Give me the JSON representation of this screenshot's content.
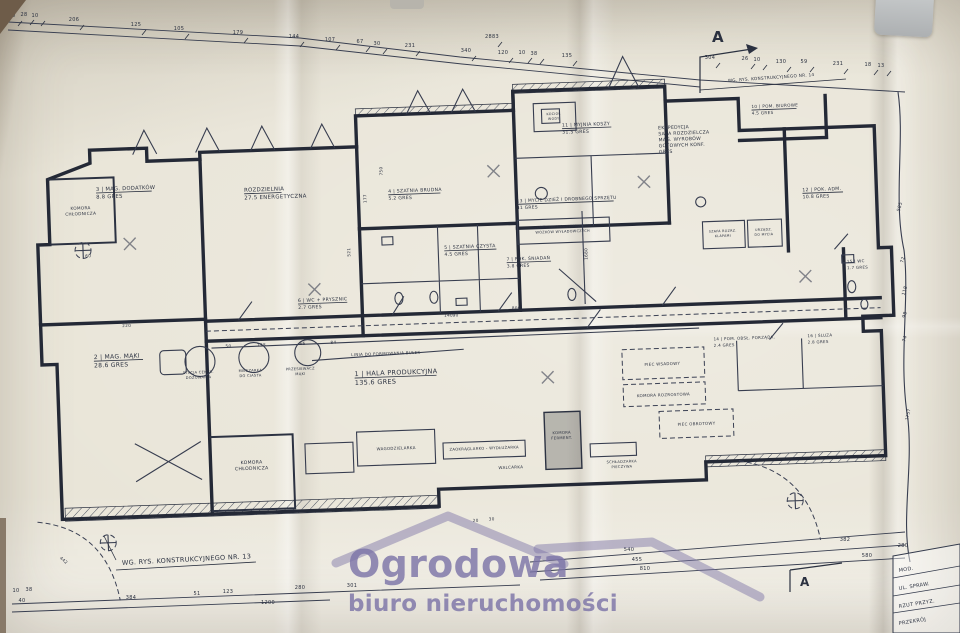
{
  "watermark": {
    "line1": "Ogrodowa",
    "line2": "biuro nieruchomości"
  },
  "annotations": {
    "note_bottom": "WG. RYS. KONSTRUKCYJNEGO NR. 13",
    "note_top": "WG. RYS. KONSTRUKCYJNEGO NR. 14",
    "section_top": "A",
    "section_bottom": "A",
    "ekspedycja": [
      "EKSPEDYCJA",
      "SALA ROZDZIELCZA",
      "MAG. WYROBÓW",
      "GOTOWYCH KONF.",
      "GRES"
    ]
  },
  "rooms": [
    {
      "id": "1",
      "name": "HALA PRODUKCYJNA",
      "area": "135.6",
      "finish": "GRES",
      "lines": [
        "1 | HALA PRODUKCYJNA",
        "135.6  GRES"
      ]
    },
    {
      "id": "2",
      "name": "MAG. MĄKI",
      "area": "28.6",
      "finish": "GRES",
      "lines": [
        "2 | MAG. MĄKI",
        "28.6  GRES"
      ]
    },
    {
      "id": "3",
      "name": "MAG. DODATKÓW",
      "area": "8.8",
      "finish": "GRES",
      "lines": [
        "3 | MAG. DODATKÓW",
        "8.8  GRES"
      ]
    },
    {
      "id": "4",
      "name": "SZATNIA BRUDNA",
      "area": "5.2",
      "finish": "GRES",
      "lines": [
        "4 | SZATNIA BRUDNA",
        "5.2  GRES"
      ]
    },
    {
      "id": "5",
      "name": "SZATNIA CZYSTA",
      "area": "4.5",
      "finish": "GRES",
      "lines": [
        "5 | SZATNIA CZYSTA",
        "4.5  GRES"
      ]
    },
    {
      "id": "6",
      "name": "WC + PRYSZNIC",
      "area": "2.7",
      "finish": "GRES",
      "lines": [
        "6 | WC + PRYSZNIC",
        "2.7  GRES"
      ]
    },
    {
      "id": "7",
      "name": "POK. ŚNIADAŃ",
      "area": "3.8",
      "finish": "GRES",
      "lines": [
        "7 | POK. ŚNIADAŃ",
        "3.8  GRES"
      ]
    },
    {
      "id": "9",
      "name": "ROZDZIELNIA ENERGETYCZNA",
      "area": "27.5",
      "finish": "",
      "lines": [
        "ROZDZIELNIA",
        "27.5  ENERGETYCZNA"
      ]
    },
    {
      "id": "11",
      "name": "MYJNIA KOSZY",
      "area": "31.5",
      "finish": "GRES",
      "lines": [
        "11 | MYJNIA KOSZY",
        "31.5  GRES"
      ]
    },
    {
      "id": "10",
      "name": "POM. BIUROWE",
      "area": "4.5",
      "finish": "GRES",
      "lines": [
        "10 | POM. BIUROWE",
        "4.5  GRES"
      ]
    },
    {
      "id": "12",
      "name": "POK. ADM.",
      "area": "10.8",
      "finish": "GRES",
      "lines": [
        "12 | POK. ADM.",
        "10.8  GRES"
      ]
    },
    {
      "id": "13",
      "name": "MYCIE DZIEŻ I DROBNEGO SPRZĘTU",
      "area": "41",
      "finish": "GRES",
      "lines": [
        "13 | MYCIE DZIEŻ I DROBNEGO SPRZĘTU",
        "41  GRES"
      ]
    },
    {
      "id": "14",
      "name": "POM. OBSŁ. PORZĄDK.",
      "area": "2.4",
      "finish": "GRES",
      "lines": [
        "14 | POM. OBSŁ. PORZĄDK.",
        "2.4  GRES"
      ]
    },
    {
      "id": "15",
      "name": "WC",
      "area": "1.7",
      "finish": "GRES",
      "lines": [
        "15 | WC",
        "1.7  GRES"
      ]
    },
    {
      "id": "16",
      "name": "ŚLUZA",
      "area": "2.8",
      "finish": "GRES",
      "lines": [
        "16 | ŚLUZA",
        "2.8  GRES"
      ]
    }
  ],
  "equipment": [
    {
      "label": "KOMORA CHŁODNICZA",
      "lines": [
        "KOMORA",
        "CHŁODNICZA"
      ]
    },
    {
      "label": "KOMORA CHŁODNICZA",
      "lines": [
        "KOMORA",
        "CHŁODNICZA"
      ]
    },
    {
      "label": "STACJA CENTR. DOZOWANIA",
      "lines": [
        "STACJA CENTR.",
        "DOZOWANIA"
      ]
    },
    {
      "label": "MIESZARKA DO CIASTA",
      "lines": [
        "MIESZARKA",
        "DO CIASTA"
      ]
    },
    {
      "label": "PRZESIEWACZ MĄKI",
      "lines": [
        "PRZESIEWACZ",
        "MĄKI"
      ]
    },
    {
      "label": "LINIA DO FORMOWANIA BUŁEK",
      "lines": [
        "LINIA DO FORMOWANIA BUŁEK"
      ]
    },
    {
      "label": "WAGODZIELARKA",
      "lines": [
        "WAGODZIELARKA"
      ]
    },
    {
      "label": "ZAOKRĄGLARKO - WYDŁUŻARKA",
      "lines": [
        "ZAOKRĄGLARKO - WYDŁUŻARKA"
      ]
    },
    {
      "label": "WALCARKA",
      "lines": [
        "WALCARKA"
      ]
    },
    {
      "label": "KOMORA FERMENT.",
      "lines": [
        "KOMORA",
        "FERMENT."
      ]
    },
    {
      "label": "SCHŁADZARKA PIECZYWA",
      "lines": [
        "SCHŁADZARKA",
        "PIECZYWA"
      ]
    },
    {
      "label": "PIEC WSADOWY",
      "lines": [
        "PIEC WSADOWY"
      ]
    },
    {
      "label": "KOMORA ROZROSTOWA",
      "lines": [
        "KOMORA ROZROSTOWA"
      ]
    },
    {
      "label": "PIEC OBROTOWY",
      "lines": [
        "PIEC OBROTOWY"
      ]
    },
    {
      "label": "TUNEL DO WPROWADZANIA WÓZKÓW WYŁADOWCZYCH",
      "lines": [
        "TUNEL DO WPROWADZANIA",
        "WÓZKÓW WYŁADOWCZYCH"
      ]
    },
    {
      "label": "SZAFA ROZRZ. KLAPAMI",
      "lines": [
        "SZAFA ROZRZ.",
        "KLAPAMI"
      ]
    },
    {
      "label": "URZĄDZ. DO MYCIA",
      "lines": [
        "URZĄDZ.",
        "DO MYCIA"
      ]
    },
    {
      "label": "KOCIOŁ WODY",
      "lines": [
        "KOCIOŁ",
        "WODY"
      ]
    }
  ],
  "dimensions": {
    "top": [
      "10",
      "28",
      "10",
      "206",
      "125",
      "105",
      "179",
      "144",
      "107",
      "67",
      "30",
      "231",
      "2883",
      "340",
      "120",
      "10",
      "38",
      "135",
      "304",
      "26",
      "10",
      "130",
      "59",
      "231",
      "18",
      "13"
    ],
    "bottom": [
      "10",
      "38",
      "40",
      "384",
      "51",
      "123",
      "280",
      "1200",
      "301",
      "540",
      "455",
      "810",
      "382",
      "580",
      "280"
    ],
    "right": [
      "585",
      "72",
      "118",
      "98",
      "74"
    ],
    "misc": [
      "220",
      "60",
      "521",
      "177",
      "750",
      "50",
      "138",
      "66",
      "84",
      "1680",
      "800",
      "90",
      "20",
      "30",
      "442",
      "1757",
      "140"
    ]
  },
  "title_block": {
    "rows": [
      "MOD.",
      "UL. SPRAW.",
      "RZUT PRZYZ.",
      "PRZEKRÓJ"
    ]
  }
}
